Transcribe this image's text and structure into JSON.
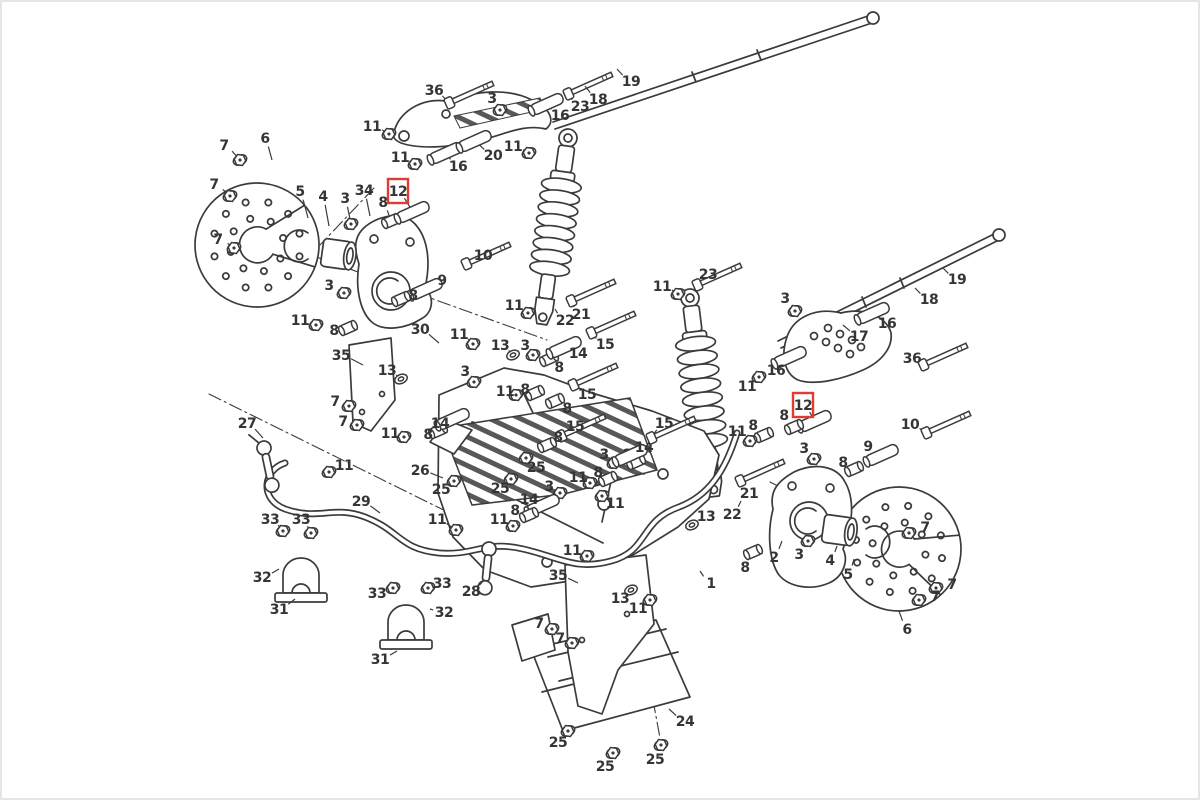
{
  "diagram": {
    "type": "exploded-parts-diagram",
    "subject": "ATV rear suspension and swing arm assembly",
    "background_color": "#ffffff",
    "line_color": "#3b3b3b",
    "highlight_color": "#e23b33",
    "highlighted_part_number": "12",
    "canvas": {
      "width": 1200,
      "height": 800
    },
    "labels": [
      {
        "n": "7",
        "x": 222,
        "y": 143,
        "t": [
          238,
          158
        ]
      },
      {
        "n": "7",
        "x": 212,
        "y": 182,
        "t": [
          228,
          194
        ]
      },
      {
        "n": "7",
        "x": 216,
        "y": 237,
        "t": [
          232,
          246
        ]
      },
      {
        "n": "6",
        "x": 263,
        "y": 136,
        "t": [
          270,
          158
        ]
      },
      {
        "n": "5",
        "x": 298,
        "y": 189,
        "t": [
          306,
          216
        ]
      },
      {
        "n": "4",
        "x": 321,
        "y": 194,
        "t": [
          327,
          224
        ]
      },
      {
        "n": "3",
        "x": 343,
        "y": 196,
        "t": [
          349,
          222
        ]
      },
      {
        "n": "34",
        "x": 362,
        "y": 188,
        "t": [
          368,
          214
        ]
      },
      {
        "n": "8",
        "x": 381,
        "y": 200,
        "t": [
          389,
          219
        ]
      },
      {
        "n": "12",
        "x": 396,
        "y": 189,
        "t": [
          411,
          210
        ],
        "red": true
      },
      {
        "n": "11",
        "x": 370,
        "y": 124,
        "t": [
          387,
          132
        ]
      },
      {
        "n": "11",
        "x": 398,
        "y": 155,
        "t": [
          413,
          162
        ]
      },
      {
        "n": "16",
        "x": 456,
        "y": 164,
        "t": [
          444,
          151
        ]
      },
      {
        "n": "20",
        "x": 491,
        "y": 153,
        "t": [
          473,
          139
        ]
      },
      {
        "n": "36",
        "x": 432,
        "y": 88,
        "t": [
          447,
          101
        ]
      },
      {
        "n": "3",
        "x": 490,
        "y": 96,
        "t": [
          498,
          108
        ]
      },
      {
        "n": "16",
        "x": 558,
        "y": 113,
        "t": [
          545,
          102
        ]
      },
      {
        "n": "23",
        "x": 578,
        "y": 104,
        "t": [
          566,
          92
        ]
      },
      {
        "n": "18",
        "x": 596,
        "y": 97,
        "t": [
          583,
          84
        ]
      },
      {
        "n": "19",
        "x": 629,
        "y": 79,
        "t": [
          615,
          67
        ]
      },
      {
        "n": "11",
        "x": 511,
        "y": 144,
        "t": [
          527,
          151
        ]
      },
      {
        "n": "10",
        "x": 481,
        "y": 253,
        "t": [
          464,
          262
        ]
      },
      {
        "n": "9",
        "x": 440,
        "y": 278,
        "t": [
          424,
          287
        ]
      },
      {
        "n": "8",
        "x": 411,
        "y": 293,
        "t": [
          399,
          297
        ]
      },
      {
        "n": "3",
        "x": 327,
        "y": 283,
        "t": [
          342,
          291
        ]
      },
      {
        "n": "11",
        "x": 298,
        "y": 318,
        "t": [
          314,
          323
        ]
      },
      {
        "n": "8",
        "x": 332,
        "y": 328,
        "t": [
          346,
          326
        ]
      },
      {
        "n": "30",
        "x": 418,
        "y": 327,
        "t": [
          437,
          341
        ]
      },
      {
        "n": "11",
        "x": 457,
        "y": 332,
        "t": [
          471,
          342
        ]
      },
      {
        "n": "35",
        "x": 339,
        "y": 353,
        "t": [
          361,
          363
        ]
      },
      {
        "n": "13",
        "x": 385,
        "y": 368,
        "t": [
          399,
          377
        ]
      },
      {
        "n": "13",
        "x": 498,
        "y": 343,
        "t": [
          511,
          353
        ]
      },
      {
        "n": "3",
        "x": 523,
        "y": 343,
        "t": [
          531,
          353
        ]
      },
      {
        "n": "11",
        "x": 512,
        "y": 303,
        "t": [
          526,
          311
        ]
      },
      {
        "n": "22",
        "x": 563,
        "y": 318,
        "t": [
          553,
          307
        ]
      },
      {
        "n": "21",
        "x": 579,
        "y": 312,
        "t": [
          569,
          299
        ]
      },
      {
        "n": "8",
        "x": 557,
        "y": 365,
        "t": [
          547,
          357
        ]
      },
      {
        "n": "14",
        "x": 576,
        "y": 351,
        "t": [
          563,
          345
        ]
      },
      {
        "n": "15",
        "x": 603,
        "y": 342,
        "t": [
          589,
          331
        ]
      },
      {
        "n": "3",
        "x": 463,
        "y": 369,
        "t": [
          472,
          380
        ]
      },
      {
        "n": "11",
        "x": 503,
        "y": 389,
        "t": [
          514,
          393
        ]
      },
      {
        "n": "8",
        "x": 523,
        "y": 387,
        "t": [
          533,
          391
        ]
      },
      {
        "n": "15",
        "x": 585,
        "y": 392,
        "t": [
          571,
          383
        ]
      },
      {
        "n": "8",
        "x": 565,
        "y": 406,
        "t": [
          553,
          399
        ]
      },
      {
        "n": "7",
        "x": 333,
        "y": 399,
        "t": [
          347,
          404
        ]
      },
      {
        "n": "7",
        "x": 341,
        "y": 419,
        "t": [
          355,
          423
        ]
      },
      {
        "n": "11",
        "x": 388,
        "y": 431,
        "t": [
          402,
          435
        ]
      },
      {
        "n": "8",
        "x": 426,
        "y": 432,
        "t": [
          436,
          429
        ]
      },
      {
        "n": "14",
        "x": 438,
        "y": 421,
        "t": [
          451,
          417
        ]
      },
      {
        "n": "26",
        "x": 418,
        "y": 468,
        "t": [
          441,
          476
        ]
      },
      {
        "n": "25",
        "x": 439,
        "y": 487,
        "t": [
          452,
          479
        ]
      },
      {
        "n": "25",
        "x": 498,
        "y": 486,
        "t": [
          509,
          477
        ]
      },
      {
        "n": "25",
        "x": 534,
        "y": 465,
        "t": [
          524,
          456
        ]
      },
      {
        "n": "15",
        "x": 573,
        "y": 424,
        "t": [
          559,
          434
        ]
      },
      {
        "n": "8",
        "x": 556,
        "y": 435,
        "t": [
          545,
          443
        ]
      },
      {
        "n": "3",
        "x": 602,
        "y": 452,
        "t": [
          612,
          461
        ]
      },
      {
        "n": "8",
        "x": 625,
        "y": 452,
        "t": [
          634,
          460
        ]
      },
      {
        "n": "14",
        "x": 642,
        "y": 445,
        "t": [
          629,
          453
        ]
      },
      {
        "n": "15",
        "x": 662,
        "y": 421,
        "t": [
          649,
          436
        ]
      },
      {
        "n": "11",
        "x": 576,
        "y": 475,
        "t": [
          588,
          481
        ]
      },
      {
        "n": "8",
        "x": 596,
        "y": 470,
        "t": [
          606,
          477
        ]
      },
      {
        "n": "3",
        "x": 547,
        "y": 484,
        "t": [
          558,
          491
        ]
      },
      {
        "n": "11",
        "x": 613,
        "y": 501,
        "t": [
          600,
          494
        ]
      },
      {
        "n": "14",
        "x": 527,
        "y": 497,
        "t": [
          541,
          503
        ]
      },
      {
        "n": "8",
        "x": 513,
        "y": 508,
        "t": [
          527,
          513
        ]
      },
      {
        "n": "11",
        "x": 497,
        "y": 517,
        "t": [
          511,
          524
        ]
      },
      {
        "n": "11",
        "x": 435,
        "y": 517,
        "t": [
          454,
          528
        ]
      },
      {
        "n": "11",
        "x": 660,
        "y": 284,
        "t": [
          676,
          292
        ]
      },
      {
        "n": "23",
        "x": 706,
        "y": 272,
        "t": [
          695,
          283
        ]
      },
      {
        "n": "3",
        "x": 783,
        "y": 296,
        "t": [
          793,
          309
        ]
      },
      {
        "n": "19",
        "x": 955,
        "y": 277,
        "t": [
          941,
          266
        ]
      },
      {
        "n": "18",
        "x": 927,
        "y": 297,
        "t": [
          913,
          286
        ]
      },
      {
        "n": "16",
        "x": 885,
        "y": 321,
        "t": [
          871,
          311
        ]
      },
      {
        "n": "17",
        "x": 857,
        "y": 334,
        "t": [
          841,
          323
        ]
      },
      {
        "n": "36",
        "x": 910,
        "y": 356,
        "t": [
          921,
          363
        ]
      },
      {
        "n": "16",
        "x": 774,
        "y": 368,
        "t": [
          788,
          355
        ]
      },
      {
        "n": "11",
        "x": 745,
        "y": 384,
        "t": [
          757,
          375
        ]
      },
      {
        "n": "12",
        "x": 801,
        "y": 403,
        "t": [
          813,
          419
        ],
        "red": true
      },
      {
        "n": "8",
        "x": 782,
        "y": 413,
        "t": [
          792,
          425
        ]
      },
      {
        "n": "8",
        "x": 751,
        "y": 423,
        "t": [
          762,
          433
        ]
      },
      {
        "n": "11",
        "x": 735,
        "y": 429,
        "t": [
          748,
          439
        ]
      },
      {
        "n": "3",
        "x": 802,
        "y": 446,
        "t": [
          812,
          457
        ]
      },
      {
        "n": "10",
        "x": 908,
        "y": 422,
        "t": [
          924,
          431
        ]
      },
      {
        "n": "9",
        "x": 866,
        "y": 444,
        "t": [
          880,
          453
        ]
      },
      {
        "n": "8",
        "x": 841,
        "y": 460,
        "t": [
          852,
          467
        ]
      },
      {
        "n": "11",
        "x": 570,
        "y": 548,
        "t": [
          585,
          554
        ]
      },
      {
        "n": "13",
        "x": 704,
        "y": 514,
        "t": [
          690,
          523
        ]
      },
      {
        "n": "22",
        "x": 730,
        "y": 512,
        "t": [
          739,
          499
        ]
      },
      {
        "n": "21",
        "x": 747,
        "y": 491,
        "t": [
          738,
          479
        ]
      },
      {
        "n": "2",
        "x": 772,
        "y": 555,
        "t": [
          780,
          539
        ]
      },
      {
        "n": "8",
        "x": 743,
        "y": 565,
        "t": [
          751,
          550
        ]
      },
      {
        "n": "1",
        "x": 709,
        "y": 581,
        "t": [
          698,
          569
        ]
      },
      {
        "n": "3",
        "x": 797,
        "y": 552,
        "t": [
          806,
          539
        ]
      },
      {
        "n": "4",
        "x": 828,
        "y": 558,
        "t": [
          835,
          544
        ]
      },
      {
        "n": "5",
        "x": 846,
        "y": 572,
        "t": [
          852,
          557
        ]
      },
      {
        "n": "6",
        "x": 905,
        "y": 627,
        "t": [
          897,
          609
        ]
      },
      {
        "n": "7",
        "x": 923,
        "y": 525,
        "t": [
          907,
          531
        ]
      },
      {
        "n": "7",
        "x": 950,
        "y": 582,
        "t": [
          934,
          586
        ]
      },
      {
        "n": "7",
        "x": 933,
        "y": 594,
        "t": [
          917,
          598
        ]
      },
      {
        "n": "27",
        "x": 245,
        "y": 421,
        "t": [
          261,
          436
        ]
      },
      {
        "n": "11",
        "x": 342,
        "y": 463,
        "t": [
          327,
          470
        ]
      },
      {
        "n": "29",
        "x": 359,
        "y": 499,
        "t": [
          378,
          511
        ]
      },
      {
        "n": "33",
        "x": 268,
        "y": 517,
        "t": [
          281,
          529
        ]
      },
      {
        "n": "33",
        "x": 299,
        "y": 517,
        "t": [
          309,
          531
        ]
      },
      {
        "n": "32",
        "x": 260,
        "y": 575,
        "t": [
          277,
          567
        ]
      },
      {
        "n": "31",
        "x": 277,
        "y": 607,
        "t": [
          293,
          597
        ]
      },
      {
        "n": "33",
        "x": 375,
        "y": 591,
        "t": [
          391,
          586
        ]
      },
      {
        "n": "33",
        "x": 440,
        "y": 581,
        "t": [
          426,
          586
        ]
      },
      {
        "n": "32",
        "x": 442,
        "y": 610,
        "t": [
          428,
          607
        ]
      },
      {
        "n": "31",
        "x": 378,
        "y": 657,
        "t": [
          395,
          649
        ]
      },
      {
        "n": "28",
        "x": 469,
        "y": 589,
        "t": [
          482,
          578
        ]
      },
      {
        "n": "35",
        "x": 556,
        "y": 573,
        "t": [
          576,
          581
        ]
      },
      {
        "n": "13",
        "x": 618,
        "y": 596,
        "t": [
          629,
          588
        ]
      },
      {
        "n": "11",
        "x": 636,
        "y": 606,
        "t": [
          648,
          598
        ]
      },
      {
        "n": "7",
        "x": 537,
        "y": 621,
        "t": [
          550,
          627
        ]
      },
      {
        "n": "7",
        "x": 558,
        "y": 636,
        "t": [
          570,
          641
        ]
      },
      {
        "n": "24",
        "x": 683,
        "y": 719,
        "t": [
          667,
          707
        ]
      },
      {
        "n": "25",
        "x": 556,
        "y": 740,
        "t": [
          566,
          729
        ]
      },
      {
        "n": "25",
        "x": 603,
        "y": 764,
        "t": [
          611,
          751
        ]
      },
      {
        "n": "25",
        "x": 653,
        "y": 757,
        "t": [
          659,
          743
        ]
      }
    ]
  }
}
